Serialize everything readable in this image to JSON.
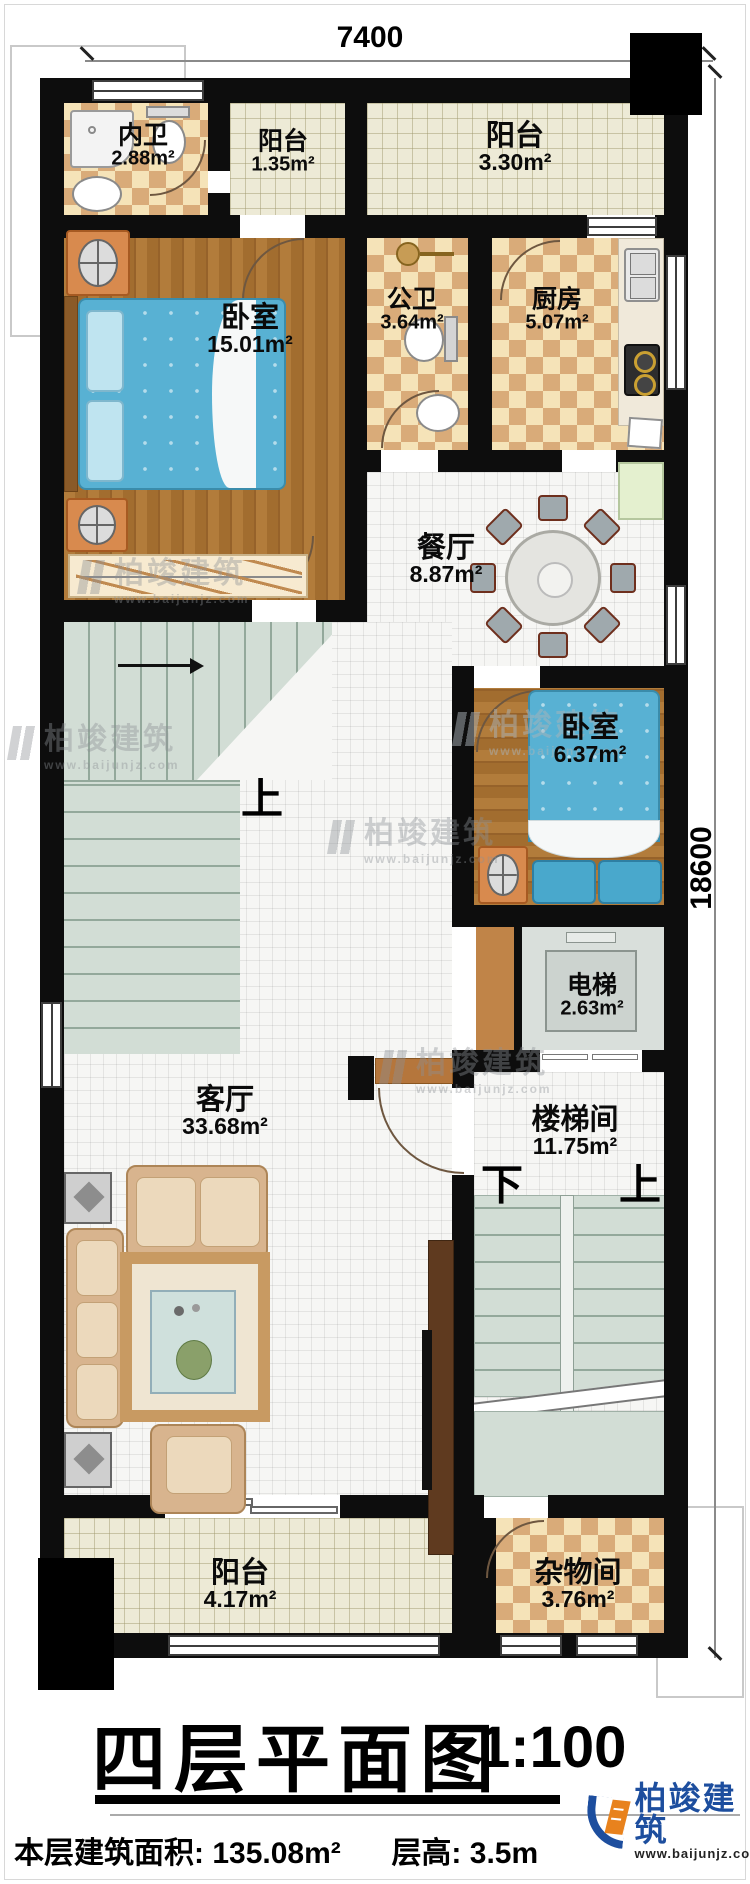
{
  "dimensions": {
    "top": "7400",
    "right": "18600"
  },
  "rooms": {
    "neiwei": {
      "name": "内卫",
      "area": "2.88m²"
    },
    "balcony_tl": {
      "name": "阳台",
      "area": "1.35m²"
    },
    "balcony_tr": {
      "name": "阳台",
      "area": "3.30m²"
    },
    "bedroom_main": {
      "name": "卧室",
      "area": "15.01m²"
    },
    "public_bath": {
      "name": "公卫",
      "area": "3.64m²"
    },
    "kitchen": {
      "name": "厨房",
      "area": "5.07m²"
    },
    "dining": {
      "name": "餐厅",
      "area": "8.87m²"
    },
    "bedroom_small": {
      "name": "卧室",
      "area": "6.37m²"
    },
    "elevator": {
      "name": "电梯",
      "area": "2.63m²"
    },
    "stairwell": {
      "name": "楼梯间",
      "area": "11.75m²"
    },
    "living": {
      "name": "客厅",
      "area": "33.68m²"
    },
    "balcony_b": {
      "name": "阳台",
      "area": "4.17m²"
    },
    "storage": {
      "name": "杂物间",
      "area": "3.76m²"
    }
  },
  "stairs": {
    "up_inner": "上",
    "down": "下",
    "up_outer": "上"
  },
  "watermark": {
    "brand": "柏竣建筑",
    "url": "www.baijunjz.com"
  },
  "title_block": {
    "title": "四层平面图",
    "scale": "1:100",
    "info_area": "本层建筑面积: 135.08m²",
    "info_height": "层高: 3.5m"
  },
  "logo": {
    "brand": "柏竣建筑",
    "url": "www.baijunjz.com"
  },
  "colors": {
    "wall": "#0d0d0d",
    "bed": "#58b1d3",
    "brand_blue": "#1d4e9e",
    "brand_orange": "#e8821d"
  }
}
